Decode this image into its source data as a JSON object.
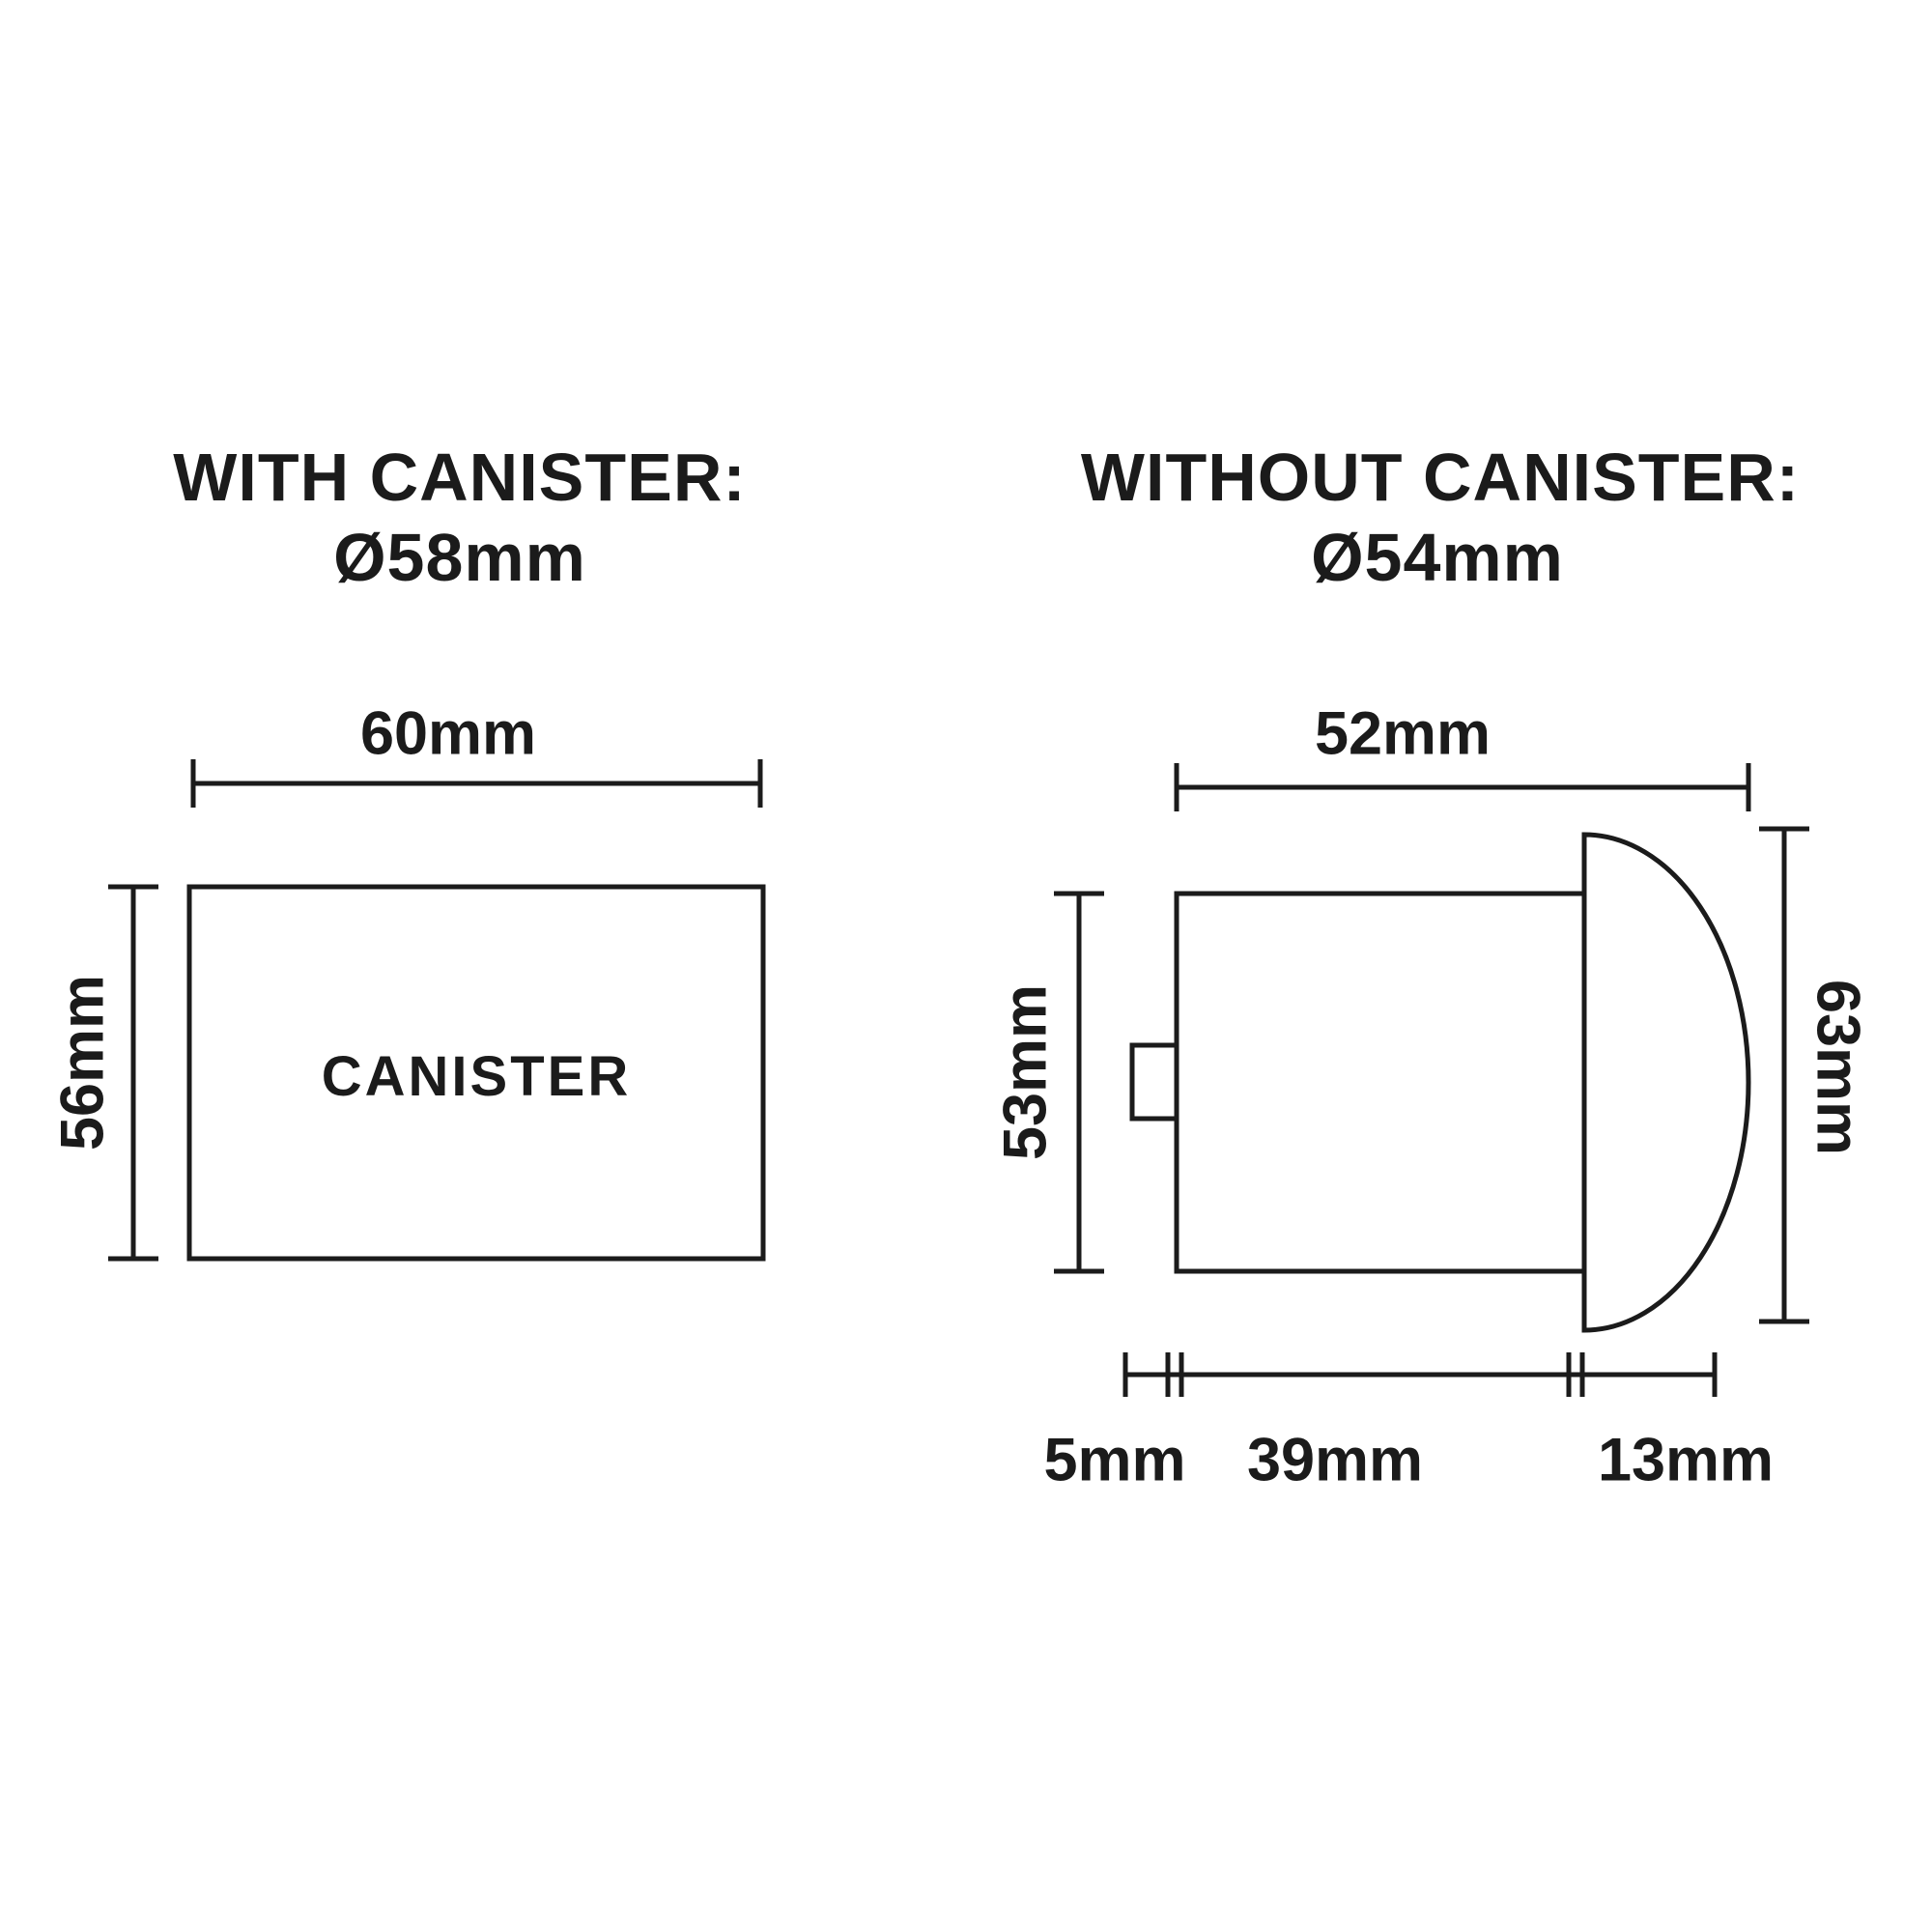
{
  "page": {
    "background": "#ffffff",
    "ink": "#1b1b1b"
  },
  "left_diagram": {
    "title_line1": "WITH CANISTER:",
    "diameter": "Ø58mm",
    "width_label": "60mm",
    "height_label": "56mm",
    "body_label": "CANISTER"
  },
  "right_diagram": {
    "title_line1": "WITHOUT CANISTER:",
    "diameter": "Ø54mm",
    "width_label": "52mm",
    "body_height_label": "53mm",
    "overall_height_label": "63mm",
    "nub_depth_label": "5mm",
    "body_depth_label": "39mm",
    "dome_depth_label": "13mm"
  }
}
